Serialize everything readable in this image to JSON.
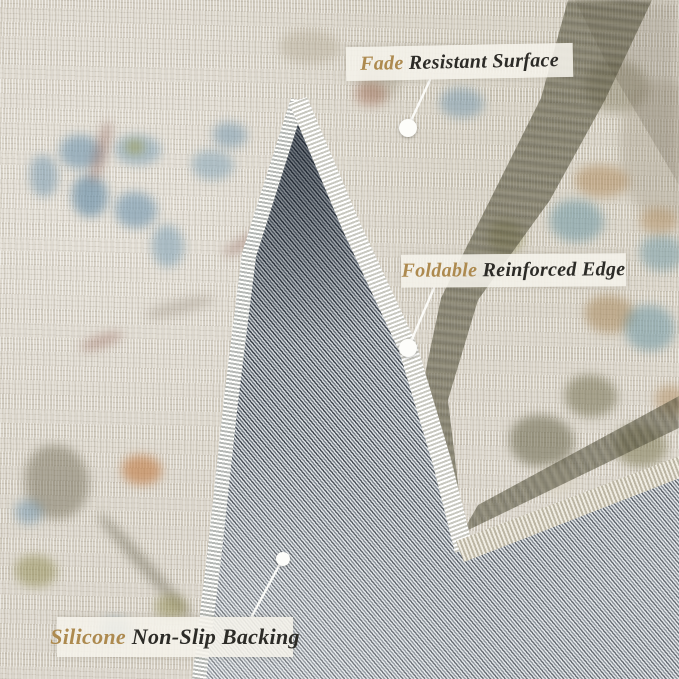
{
  "callouts": [
    {
      "id": "fade-resistant-surface",
      "highlight": "Fade",
      "rest": " Resistant Surface"
    },
    {
      "id": "foldable-reinforced-edge",
      "highlight": "Foldable",
      "rest": " Reinforced Edge"
    },
    {
      "id": "silicone-non-slip-backing",
      "highlight": "Silicone",
      "rest": " Non-Slip Backing"
    }
  ],
  "colors": {
    "highlight_text": "#ad8a4f",
    "label_text": "#2c2b27",
    "label_background": "rgba(245,242,235,0.88)",
    "rug_surface_base": "#d8d2c6",
    "rug_backing_gray": "#8b939c",
    "binding_white": "#eceae3",
    "accent_blue": "#6f94ad",
    "accent_olive": "#8f8c54",
    "accent_rust": "#b0764f"
  }
}
